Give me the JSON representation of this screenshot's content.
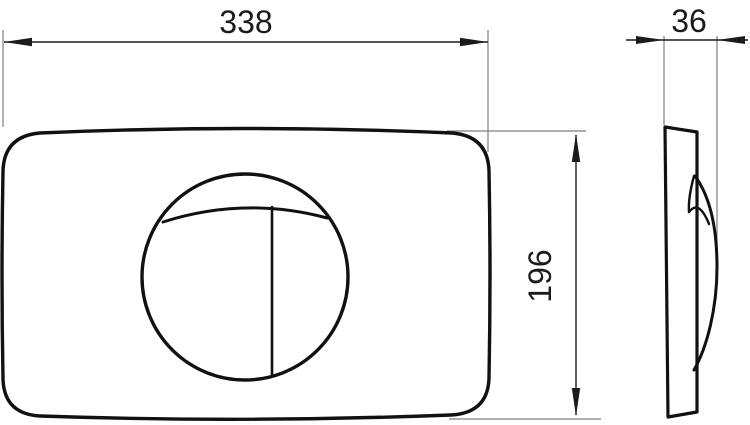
{
  "colors": {
    "line": "#111111",
    "dimension": "#1b1b1b",
    "extension": "#7d7d7d",
    "background": "#ffffff"
  },
  "views": {
    "front": {
      "width_mm": "338",
      "height_mm": "196"
    },
    "side": {
      "depth_mm": "36"
    }
  }
}
